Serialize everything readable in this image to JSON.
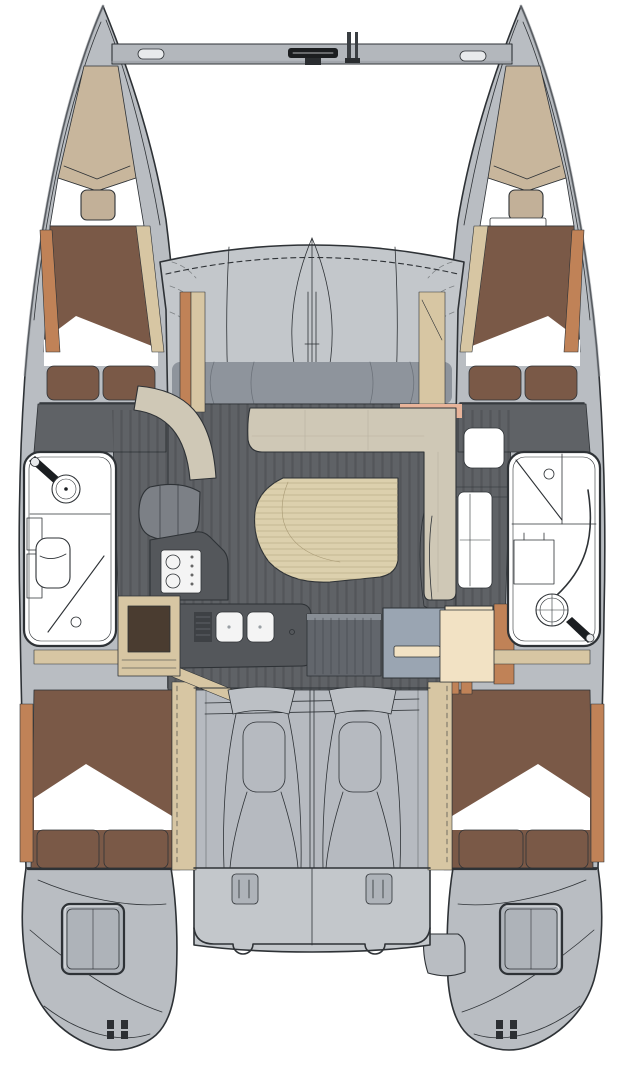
{
  "meta": {
    "subject": "catamaran-interior-floorplan",
    "view": "top-down"
  },
  "palette": {
    "page_bg": "#ffffff",
    "outline": "#2e3236",
    "hull": "#b9bdc2",
    "hull_shade": "#8d9399",
    "beam": "#b3b7bc",
    "beam_dark": "#1c1e20",
    "chrome": "#e8eaec",
    "superstructure": "#c3c7cb",
    "cockpit": "#b6bac0",
    "window_band": "#8e949c",
    "pillar_line": "#6d737b",
    "companionway": "#62666c",
    "companionway_top": "#888e95",
    "tan": "#c8b69c",
    "pillow": "#c2b098",
    "duvet": "#7a5947",
    "sheet": "#ffffff",
    "wood": "#c08257",
    "wood_dark": "#4a3c30",
    "light_wood": "#d7c6a3",
    "salmon": "#e8b49a",
    "floor": "#5f6266",
    "settee": "#cfc8b6",
    "table": "#dcd0ad",
    "counter": "#54575b",
    "counter_dark": "#3e4145",
    "appliance": "#f4f4f4",
    "cabinet_blue": "#9aa5b2",
    "cabinet_cream": "#f2e2c4",
    "fixture_dark": "#1b1e21",
    "fixture_white": "#ffffff",
    "chair": "#7c8086",
    "hatch_fill": "#aeb3b9",
    "seam": "#b9b1a0",
    "grain_table": "#a89a74"
  },
  "regions": {
    "bow_crossbeam": "bow-crossbeam",
    "trampoline": "trampoline",
    "port_forepeak": "port-forepeak",
    "starboard_forepeak": "starboard-forepeak",
    "port_forward_berth": "port-forward-berth",
    "starboard_forward_berth": "starboard-forward-berth",
    "port_head": "port-head",
    "starboard_head": "starboard-head",
    "salon": "salon",
    "settee": "l-shaped-settee",
    "table": "salon-table",
    "galley": "galley",
    "nav_cabinet": "nav-cabinet",
    "cockpit": "cockpit",
    "port_aft_berth": "port-aft-berth",
    "starboard_aft_berth": "starboard-aft-berth",
    "port_transom": "port-transom",
    "starboard_transom": "starboard-transom"
  },
  "fittings": {
    "anchor_roller": "anchor-roller",
    "cleats": "mooring-cleats",
    "stove": "two-burner-stove",
    "sink": "double-sink",
    "toilet": "marine-toilet",
    "shower": "shower",
    "transom_hatch": "transom-storage-hatch"
  }
}
